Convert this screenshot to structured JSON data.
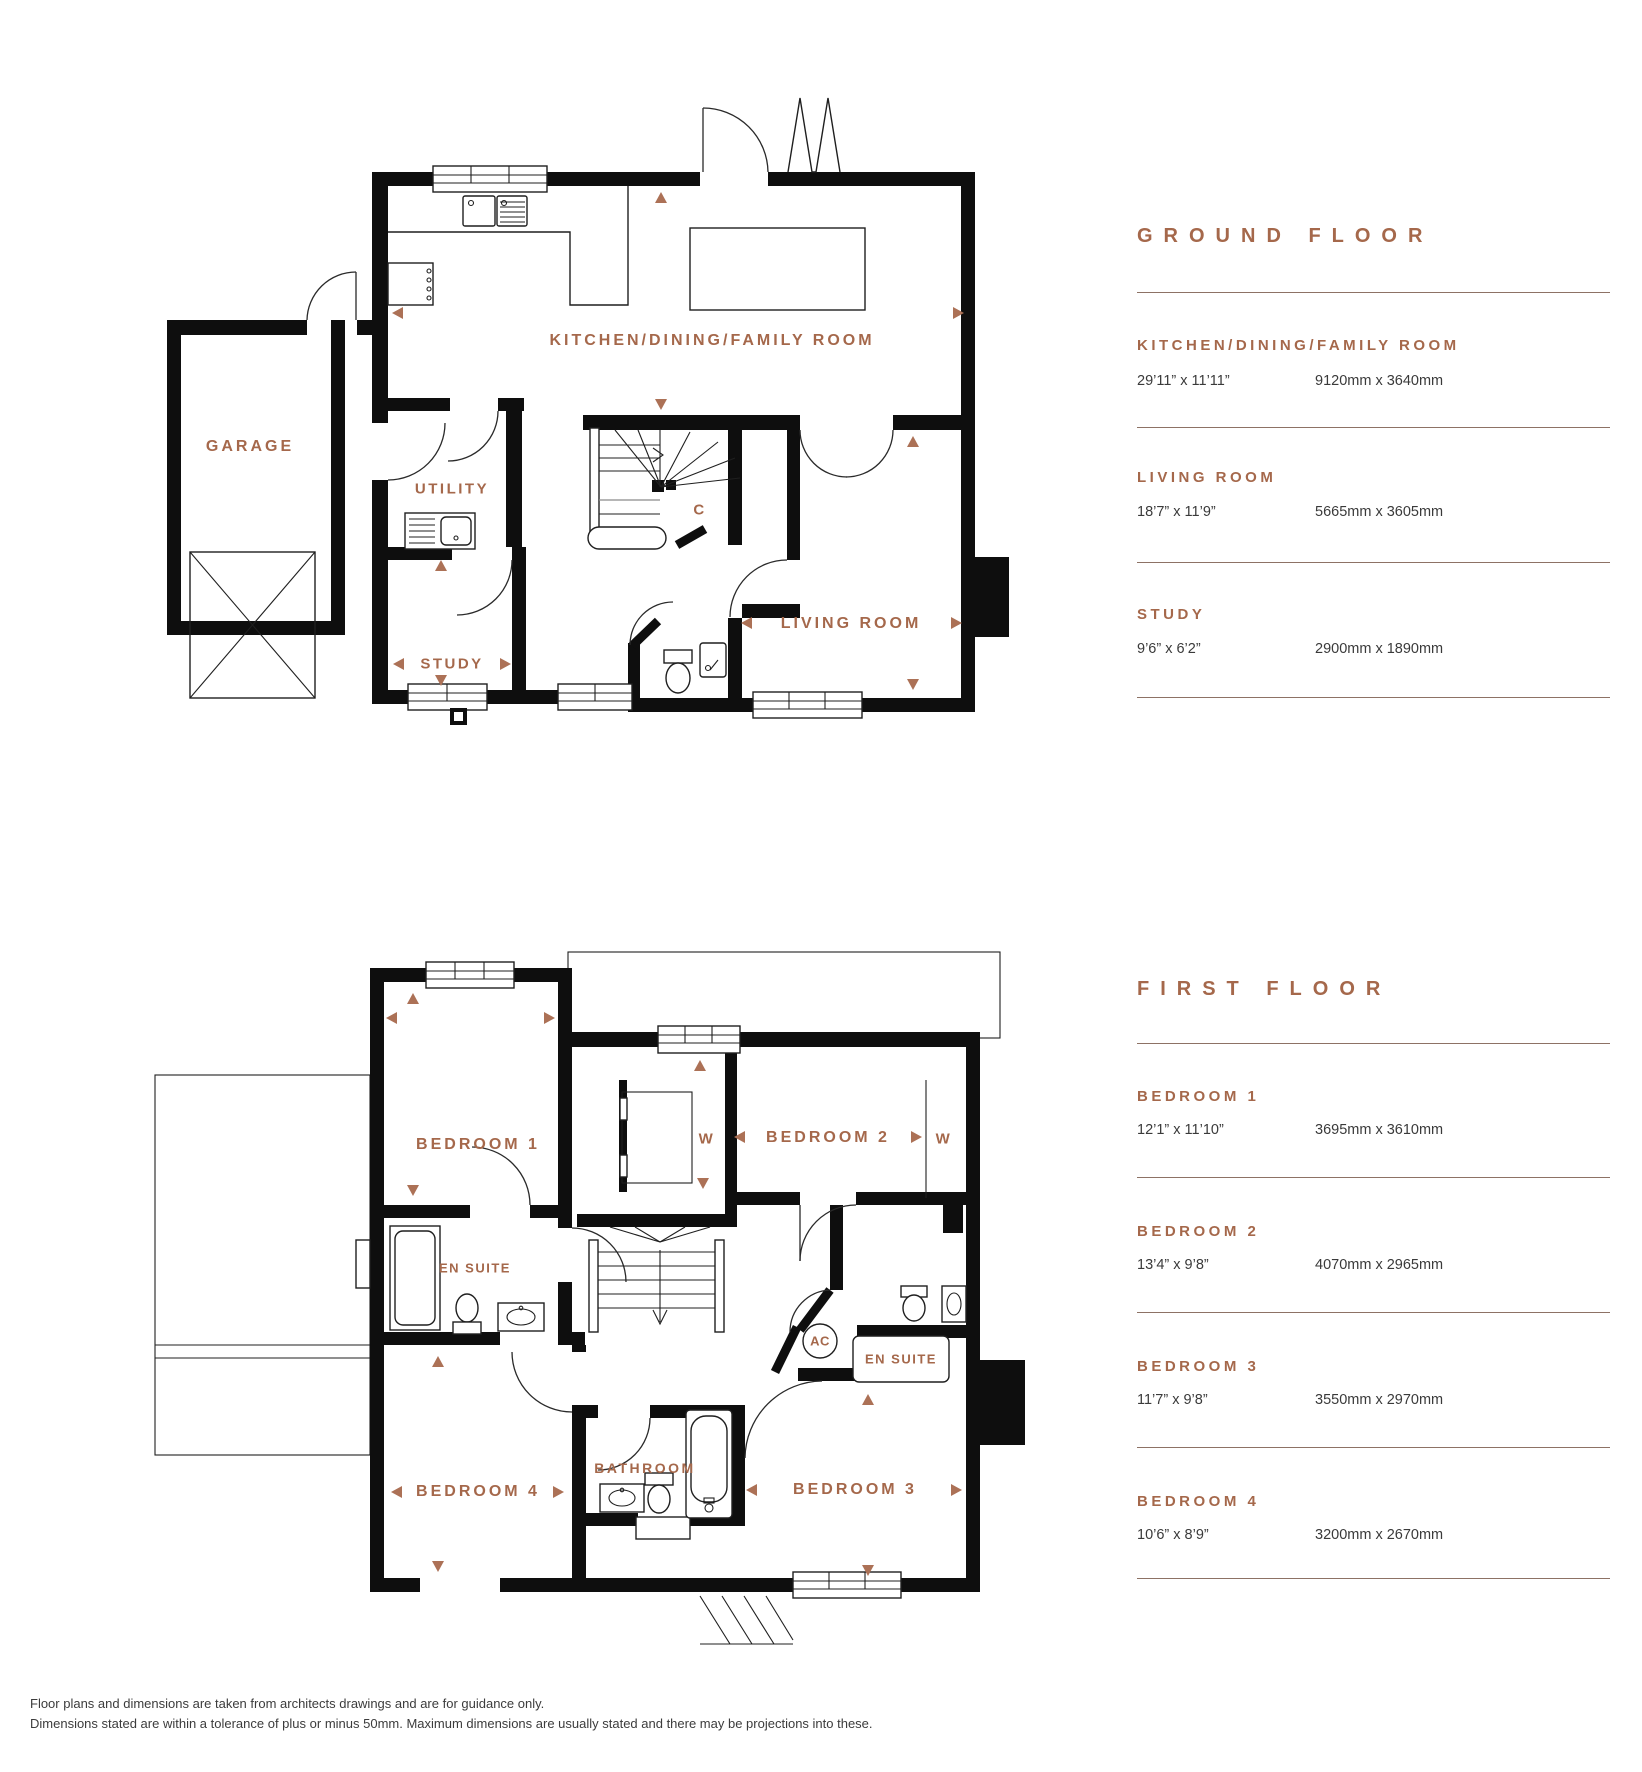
{
  "colors": {
    "accent": "#A5684B",
    "wall": "#0E0E0E",
    "dim_text": "#3A3A3A",
    "divider": "#8D7265"
  },
  "ground_floor": {
    "heading": "GROUND FLOOR",
    "rooms": [
      {
        "name": "KITCHEN/DINING/FAMILY ROOM",
        "imperial": "29’11” x 11’11”",
        "metric": "9120mm x 3640mm"
      },
      {
        "name": "LIVING ROOM",
        "imperial": "18’7” x 11’9”",
        "metric": "5665mm x 3605mm"
      },
      {
        "name": "STUDY",
        "imperial": "9’6” x 6’2”",
        "metric": "2900mm x 1890mm"
      }
    ],
    "plan": {
      "garage": "GARAGE",
      "utility": "UTILITY",
      "study": "STUDY",
      "kitchen": "KITCHEN/DINING/FAMILY ROOM",
      "living": "LIVING ROOM",
      "cupboard": "C"
    }
  },
  "first_floor": {
    "heading": "FIRST FLOOR",
    "rooms": [
      {
        "name": "BEDROOM 1",
        "imperial": "12’1” x 11’10”",
        "metric": "3695mm x 3610mm"
      },
      {
        "name": "BEDROOM 2",
        "imperial": "13’4” x 9’8”",
        "metric": "4070mm x 2965mm"
      },
      {
        "name": "BEDROOM 3",
        "imperial": "11’7” x 9’8”",
        "metric": "3550mm x 2970mm"
      },
      {
        "name": "BEDROOM 4",
        "imperial": "10’6” x 8’9”",
        "metric": "3200mm x 2670mm"
      }
    ],
    "plan": {
      "bedroom1": "BEDROOM 1",
      "bedroom2": "BEDROOM 2",
      "bedroom3": "BEDROOM 3",
      "bedroom4": "BEDROOM 4",
      "ensuite1": "EN SUITE",
      "ensuite2": "EN SUITE",
      "bathroom": "BATHROOM",
      "wardrobe1": "W",
      "wardrobe2": "W",
      "ac": "AC"
    }
  },
  "footer": {
    "line1": "Floor plans and dimensions are taken from architects drawings and are for guidance only.",
    "line2": "Dimensions stated are within a tolerance of plus or minus 50mm. Maximum dimensions are usually stated and there may be projections into these."
  }
}
